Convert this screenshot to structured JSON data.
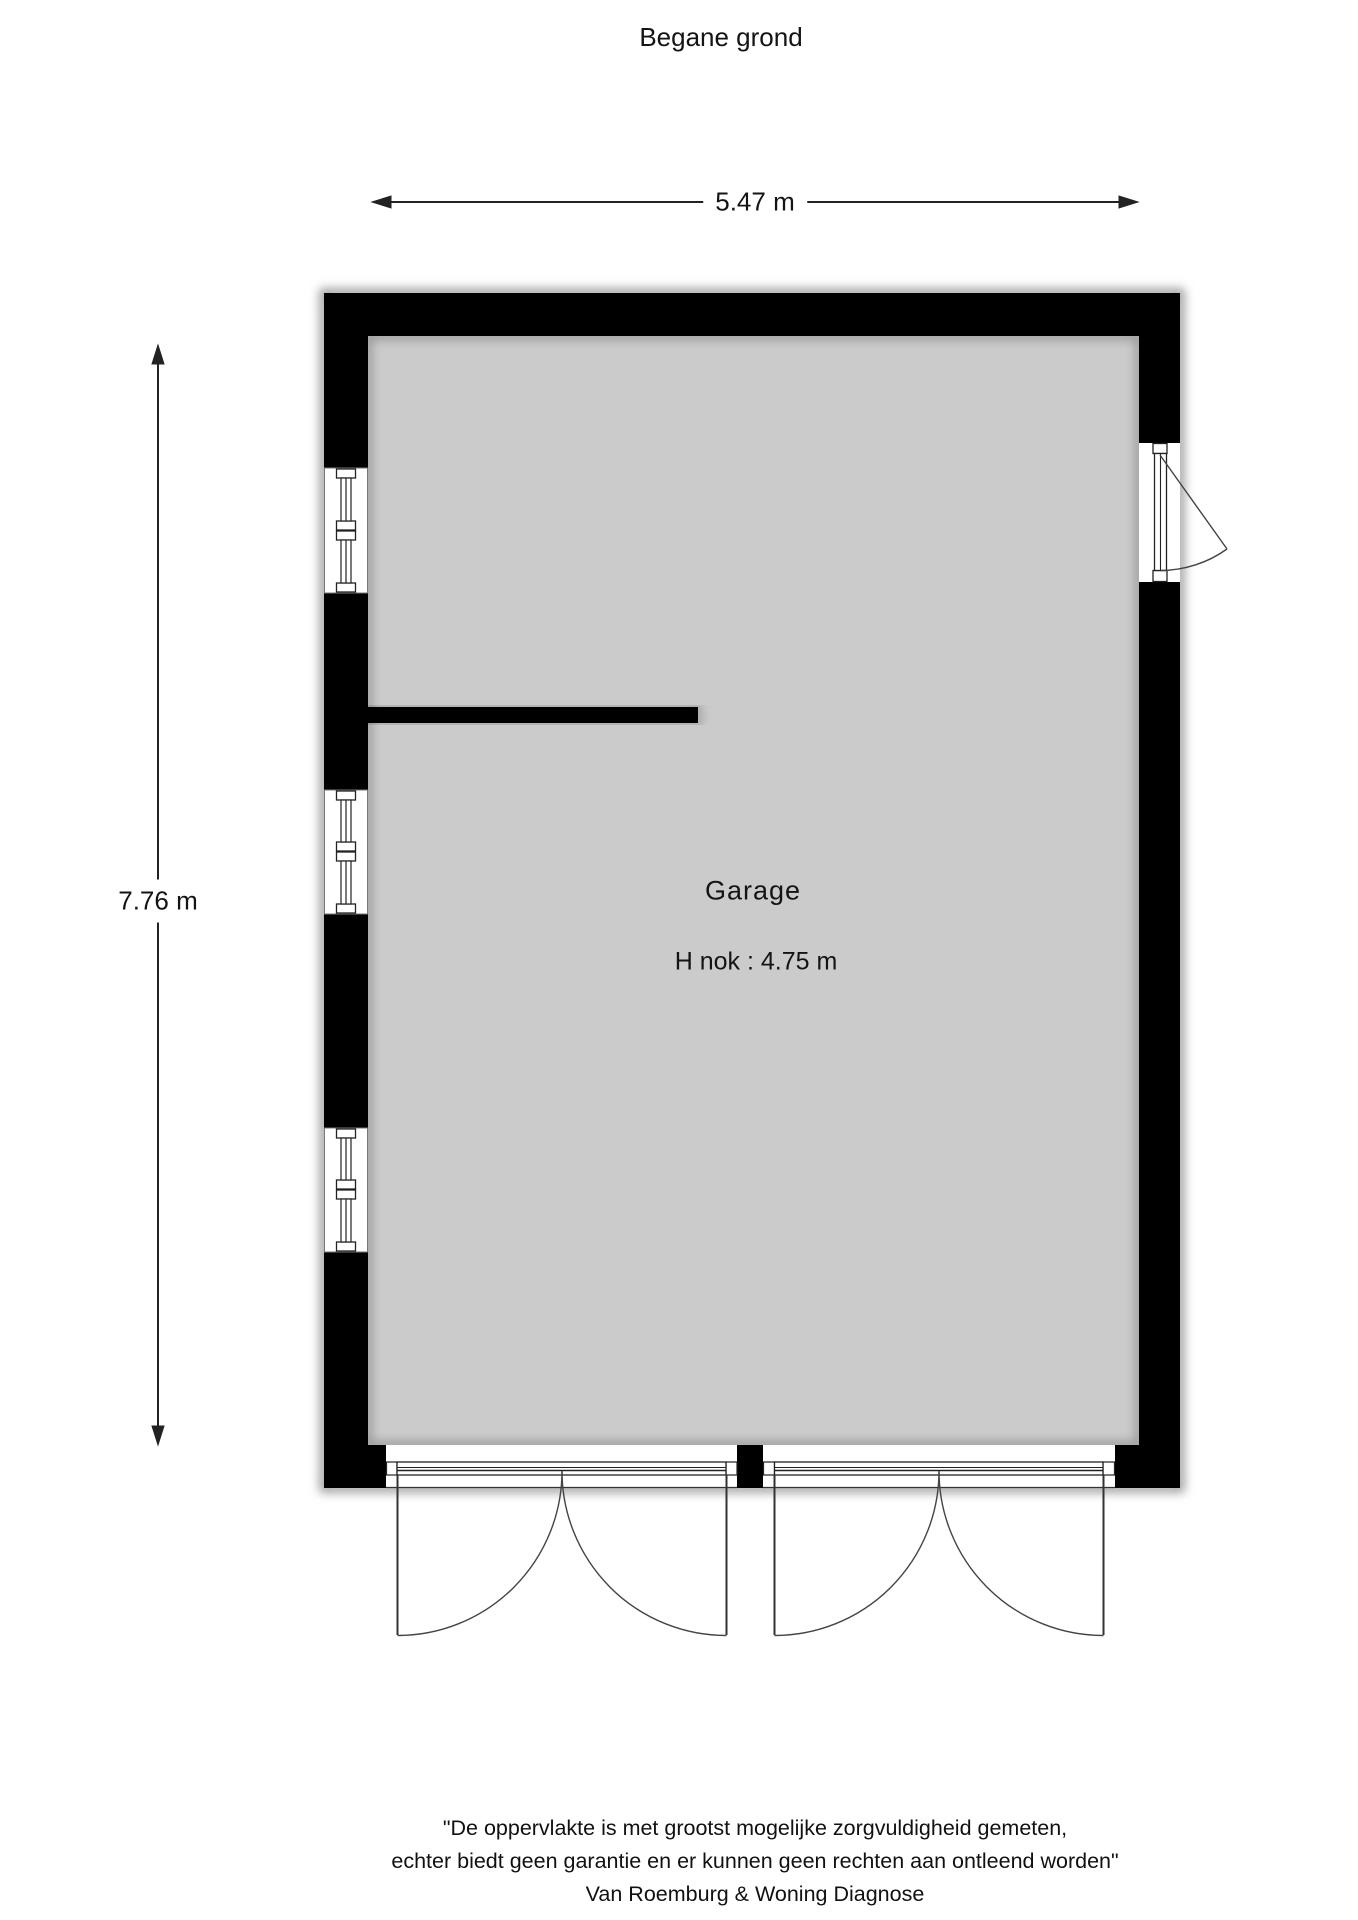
{
  "title": "Begane grond",
  "dimensions": {
    "width_label": "5.47 m",
    "height_label": "7.76 m"
  },
  "room": {
    "name": "Garage",
    "ridge_height_label": "H nok : 4.75 m"
  },
  "footer": {
    "line1": "\"De oppervlakte is met grootst mogelijke zorgvuldigheid gemeten,",
    "line2": "echter biedt geen garantie en er kunnen geen rechten aan ontleend worden\"",
    "line3": "Van Roemburg & Woning Diagnose"
  },
  "colors": {
    "wall": "#000000",
    "floor": "#cbcbcb",
    "line": "#2a2a2a",
    "background": "#ffffff"
  }
}
